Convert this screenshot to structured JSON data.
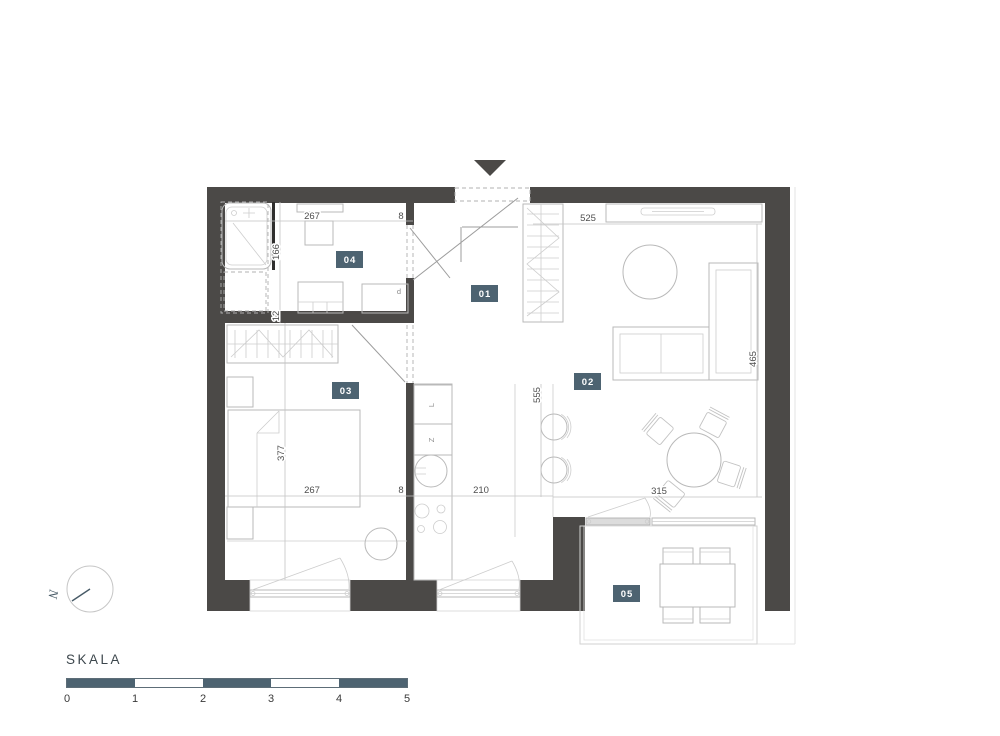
{
  "plan": {
    "room_labels": [
      "01",
      "02",
      "03",
      "04",
      "05"
    ],
    "dim_labels": {
      "bath_width": "267",
      "bath_wall": "8",
      "bath_depth": "166",
      "bath_lower": "12",
      "living_width": "525",
      "living_depth_right": "465",
      "living_height": "555",
      "kitchen_width": "210",
      "bedroom_width": "267",
      "bedroom_wall": "8",
      "bedroom_depth": "377",
      "terrace_width": "315"
    },
    "appliance_labels": {
      "fridge": "L",
      "dishwasher": "Z",
      "dryer": "d"
    }
  },
  "compass": {
    "north_letter": "N"
  },
  "scale_bar": {
    "title": "SKALA",
    "tick_labels": [
      "0",
      "1",
      "2",
      "3",
      "4",
      "5"
    ]
  },
  "colors": {
    "wall": "#4b4947",
    "accent": "#4d6371",
    "furniture_line": "#b9b9b9",
    "dim_text": "#4e4e4e"
  }
}
